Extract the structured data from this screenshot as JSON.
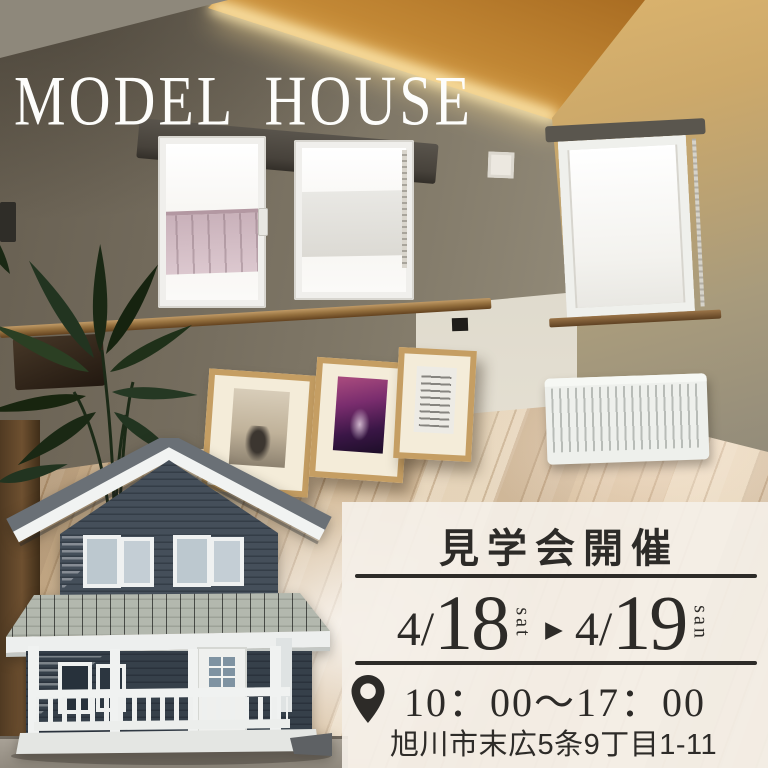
{
  "title": "MODEL HOUSE",
  "panel": {
    "heading": "見学会開催",
    "date_start": {
      "prefix": "4/",
      "day": "18",
      "weekday": "sat"
    },
    "arrow": "▶",
    "date_end": {
      "prefix": "4/",
      "day": "19",
      "weekday": "san"
    },
    "time": "10：00〜17：00",
    "address": "旭川市末広5条9丁目1-11"
  },
  "colors": {
    "panel_bg": "rgba(244,239,231,0.93)",
    "panel_text": "#2d2b28",
    "title_color": "#fdfdfb",
    "divider": "#2d2b28",
    "house_siding": "#454f5a",
    "ceiling_wood": "#c98f3a"
  }
}
